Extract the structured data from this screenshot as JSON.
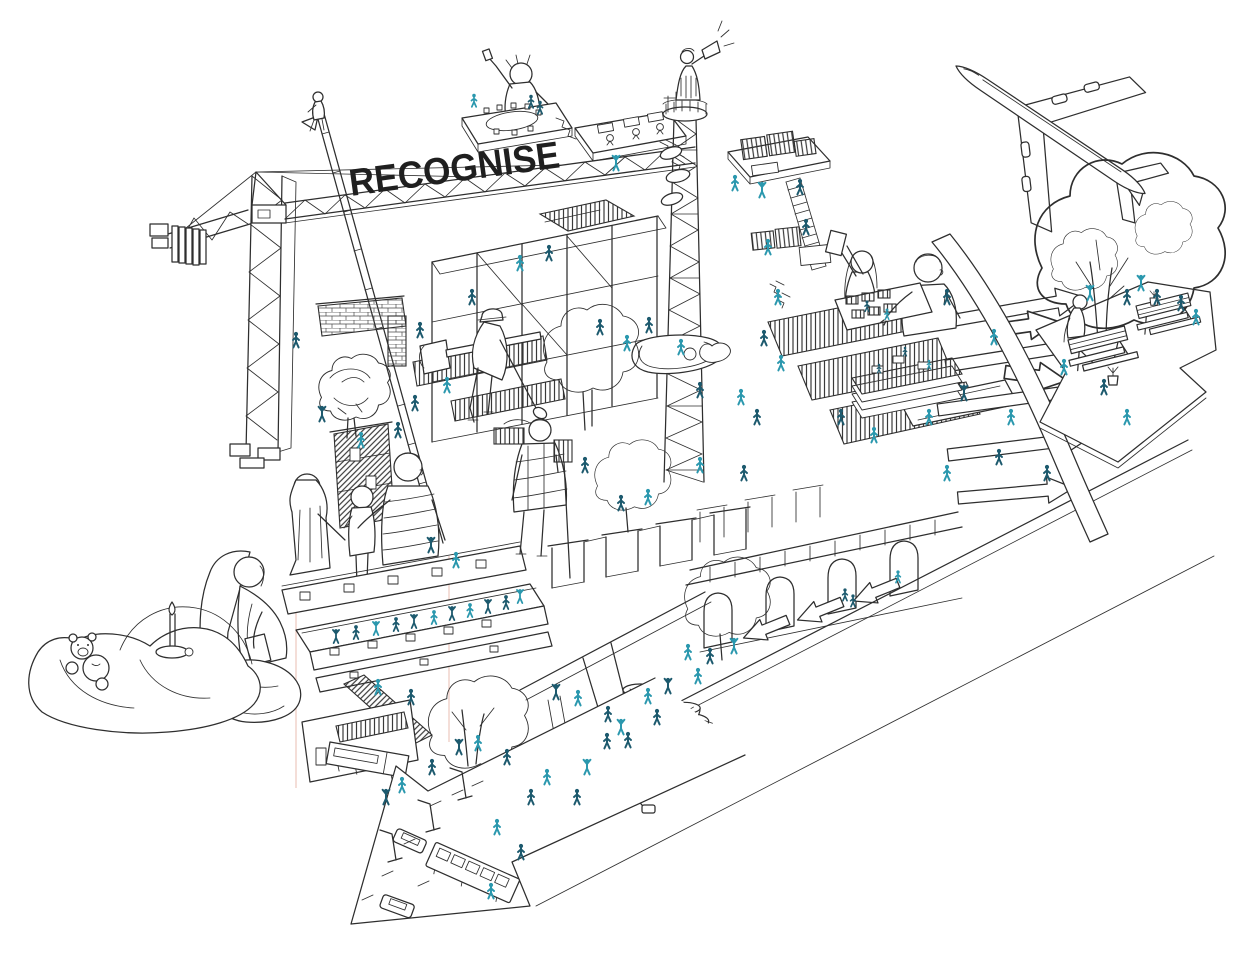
{
  "scene": {
    "title": "RECOGNISE",
    "type": "isometric-hand-drawn-architectural-illustration",
    "palette": {
      "background": "#ffffff",
      "ink": "#2e2e2e",
      "title": "#1f1f1f",
      "figure_dark_teal": "#1d5a6e",
      "figure_bright_teal": "#2b98ae",
      "guide_pink": "#e9bcb0"
    },
    "elements": [
      "tower-crane",
      "recognise-sign",
      "climbing-ladder",
      "telecom-tower",
      "megaphone-speaker",
      "airplane",
      "presenter-platform",
      "office-platform",
      "timber-platforms",
      "scaffold-frame",
      "brick-wall",
      "hatched-tower-house",
      "model-table-giants",
      "flow-arrows",
      "slide-ribbon",
      "arched-viaduct",
      "rooftop-dancers",
      "family-group",
      "plaid-shirt-man",
      "construction-worker",
      "pergola-frames",
      "pond",
      "street-arrow",
      "bus",
      "cars",
      "street-lamps",
      "sleeping-bag",
      "teddy-bear",
      "candle",
      "reading-woman",
      "swing-person",
      "coffee-cups",
      "picnic-platform",
      "picnic-tables",
      "large-tree",
      "mini-figures"
    ]
  }
}
